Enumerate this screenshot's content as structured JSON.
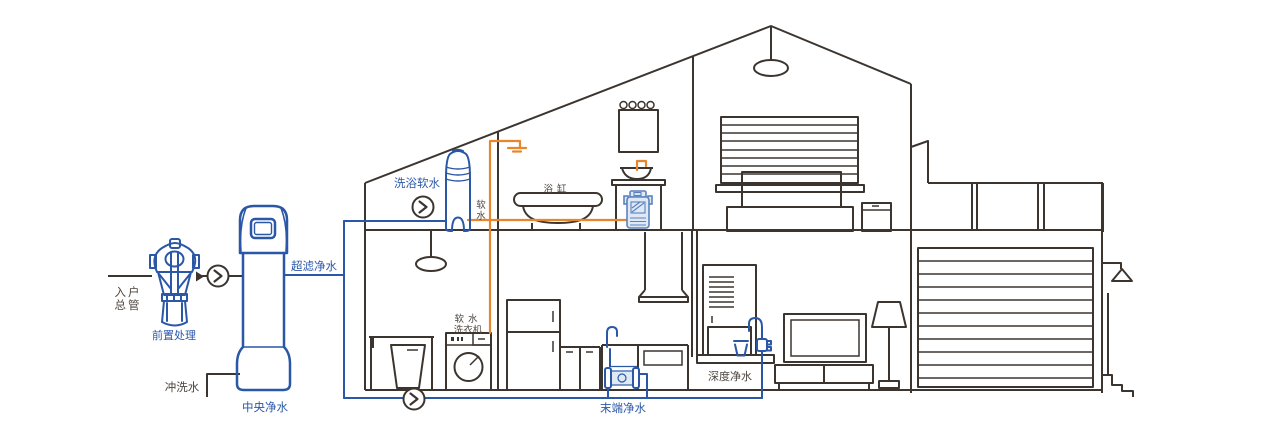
{
  "colors": {
    "line_dark": "#3c352f",
    "pipe_blue": "#2b57a7",
    "pipe_orange": "#e8862d",
    "label_dark": "#4d453e",
    "label_blue": "#2b57a7",
    "device_fill": "#dfe9f5",
    "device_stroke": "#5b82be"
  },
  "labels": {
    "inlet": {
      "line1": "入户",
      "line2": "总管"
    },
    "prefilter": "前置处理",
    "flush_water": "冲洗水",
    "central_purifier": "中央净水",
    "ultrafiltration": "超滤净水",
    "bath_softener": "洗浴软水",
    "soft_water": {
      "char1": "软",
      "char2": "水"
    },
    "bathtub": "浴缸",
    "soft_washer": {
      "line1": "软水",
      "line2": "洗衣机"
    },
    "terminal_purifier": "末端净水",
    "deep_purifier": "深度净水"
  },
  "icons": {
    "valve": "circle-with-right-chevron"
  }
}
